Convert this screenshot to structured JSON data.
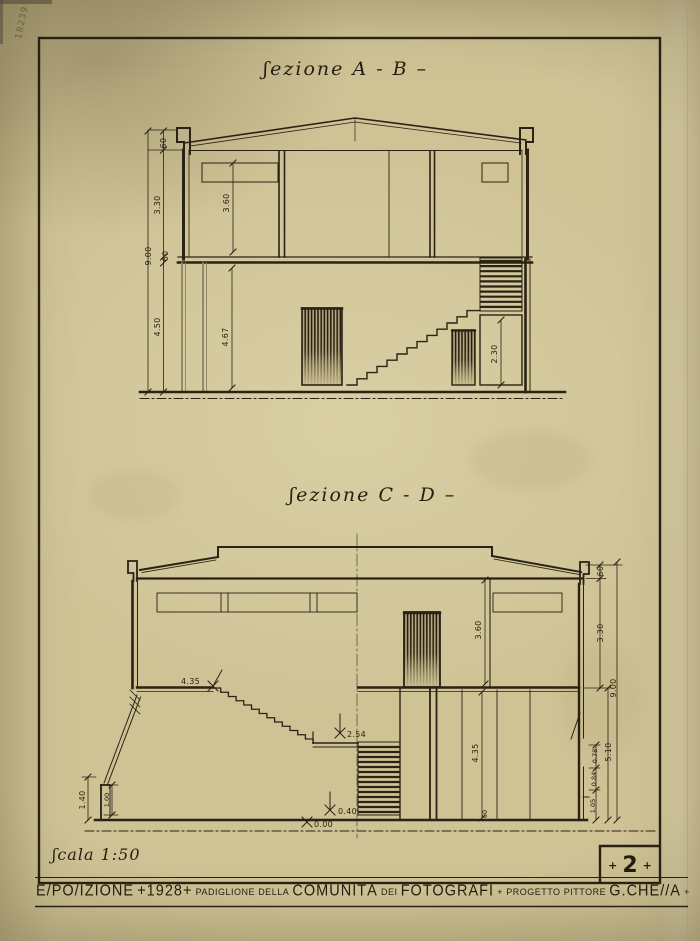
{
  "page": {
    "paper_color": "#cec293",
    "ink_color": "#2a2214"
  },
  "annotations": {
    "corner_scribble": "18239"
  },
  "sections": {
    "ab": {
      "title": "ʃezione A - B –",
      "dims": {
        "parapet": "60",
        "upper_left": "3.30",
        "total": "9.00",
        "slab": "60",
        "lower_left": "4.50",
        "upper_inner": "3.60",
        "lower_inner": "4.67",
        "understair": "2.30"
      }
    },
    "cd": {
      "title": "ʃezione C - D –",
      "dims": {
        "stair_top": "4.35",
        "landing": "2.54",
        "step": "0.40",
        "ground": "0.00",
        "upper_inner": "3.60",
        "lower_inner": "4.35",
        "base": "60",
        "right_parapet": "60",
        "right_upper": "3.30",
        "right_total": "9.00",
        "right_lower": "5.10",
        "right_small_1": "0.78",
        "right_small_2": "0.84",
        "right_small_3": "1.05",
        "left_outer": "1.40",
        "left_inner": "1.00"
      }
    }
  },
  "footer": {
    "scale": "ʃcala 1:50",
    "page_plus": "+",
    "page_num": "2",
    "banner": [
      {
        "text": "E/PO/IZIONE"
      },
      {
        "text": "+1928+"
      },
      {
        "text": "PADIGLIONE"
      },
      {
        "text": "DELLA"
      },
      {
        "text": "COMUNITÀ"
      },
      {
        "text": "DEI"
      },
      {
        "text": "FOTOGRAFI"
      },
      {
        "text": "+"
      },
      {
        "text": "PROGETTO"
      },
      {
        "text": "PITTORE"
      },
      {
        "text": "G.CHE//A"
      },
      {
        "text": "+"
      }
    ]
  }
}
